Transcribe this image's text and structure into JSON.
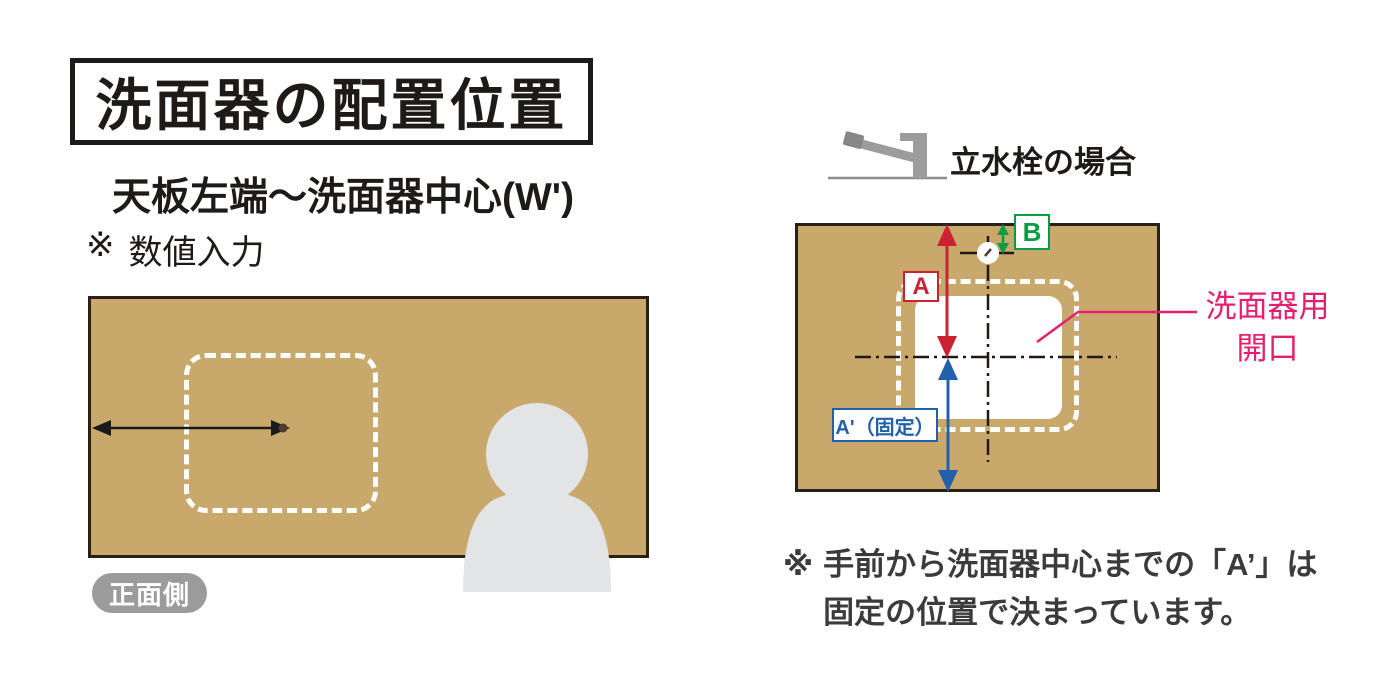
{
  "title": {
    "text": "洗面器の配置位置"
  },
  "left": {
    "subtitle": "天板左端～洗面器中心(W')",
    "note": {
      "marker": "※",
      "text": "数値入力"
    },
    "front_label": "正面側",
    "icons": {
      "dimension_arrow": "double-headed-arrow",
      "basin_center_dot": "center-point",
      "person": "person-silhouette"
    }
  },
  "right": {
    "header": "立水栓の場合",
    "icons": {
      "faucet": "faucet-side-view",
      "faucet_hole": "faucet-hole-crosshair",
      "centerlines": "dash-dot-centerlines"
    },
    "labels": {
      "a": "A",
      "b": "B",
      "a_fixed": "A'（固定）"
    },
    "opening_label": {
      "line1": "洗面器用",
      "line2": "開口"
    },
    "note": {
      "marker": "※",
      "line1": "手前から洗面器中心までの「A’」は",
      "line2": "固定の位置で決まっています。"
    }
  },
  "colors": {
    "counter_tan": "#c9a86b",
    "counter_border": "#2a2016",
    "dimension_red": "#cb2233",
    "dimension_blue": "#2360ab",
    "dimension_green": "#089d43",
    "opening_pink": "#e61e6e",
    "person_gray": "#e3e4e6",
    "badge_gray": "#9b9b9b",
    "text_black": "#1e1a17"
  }
}
